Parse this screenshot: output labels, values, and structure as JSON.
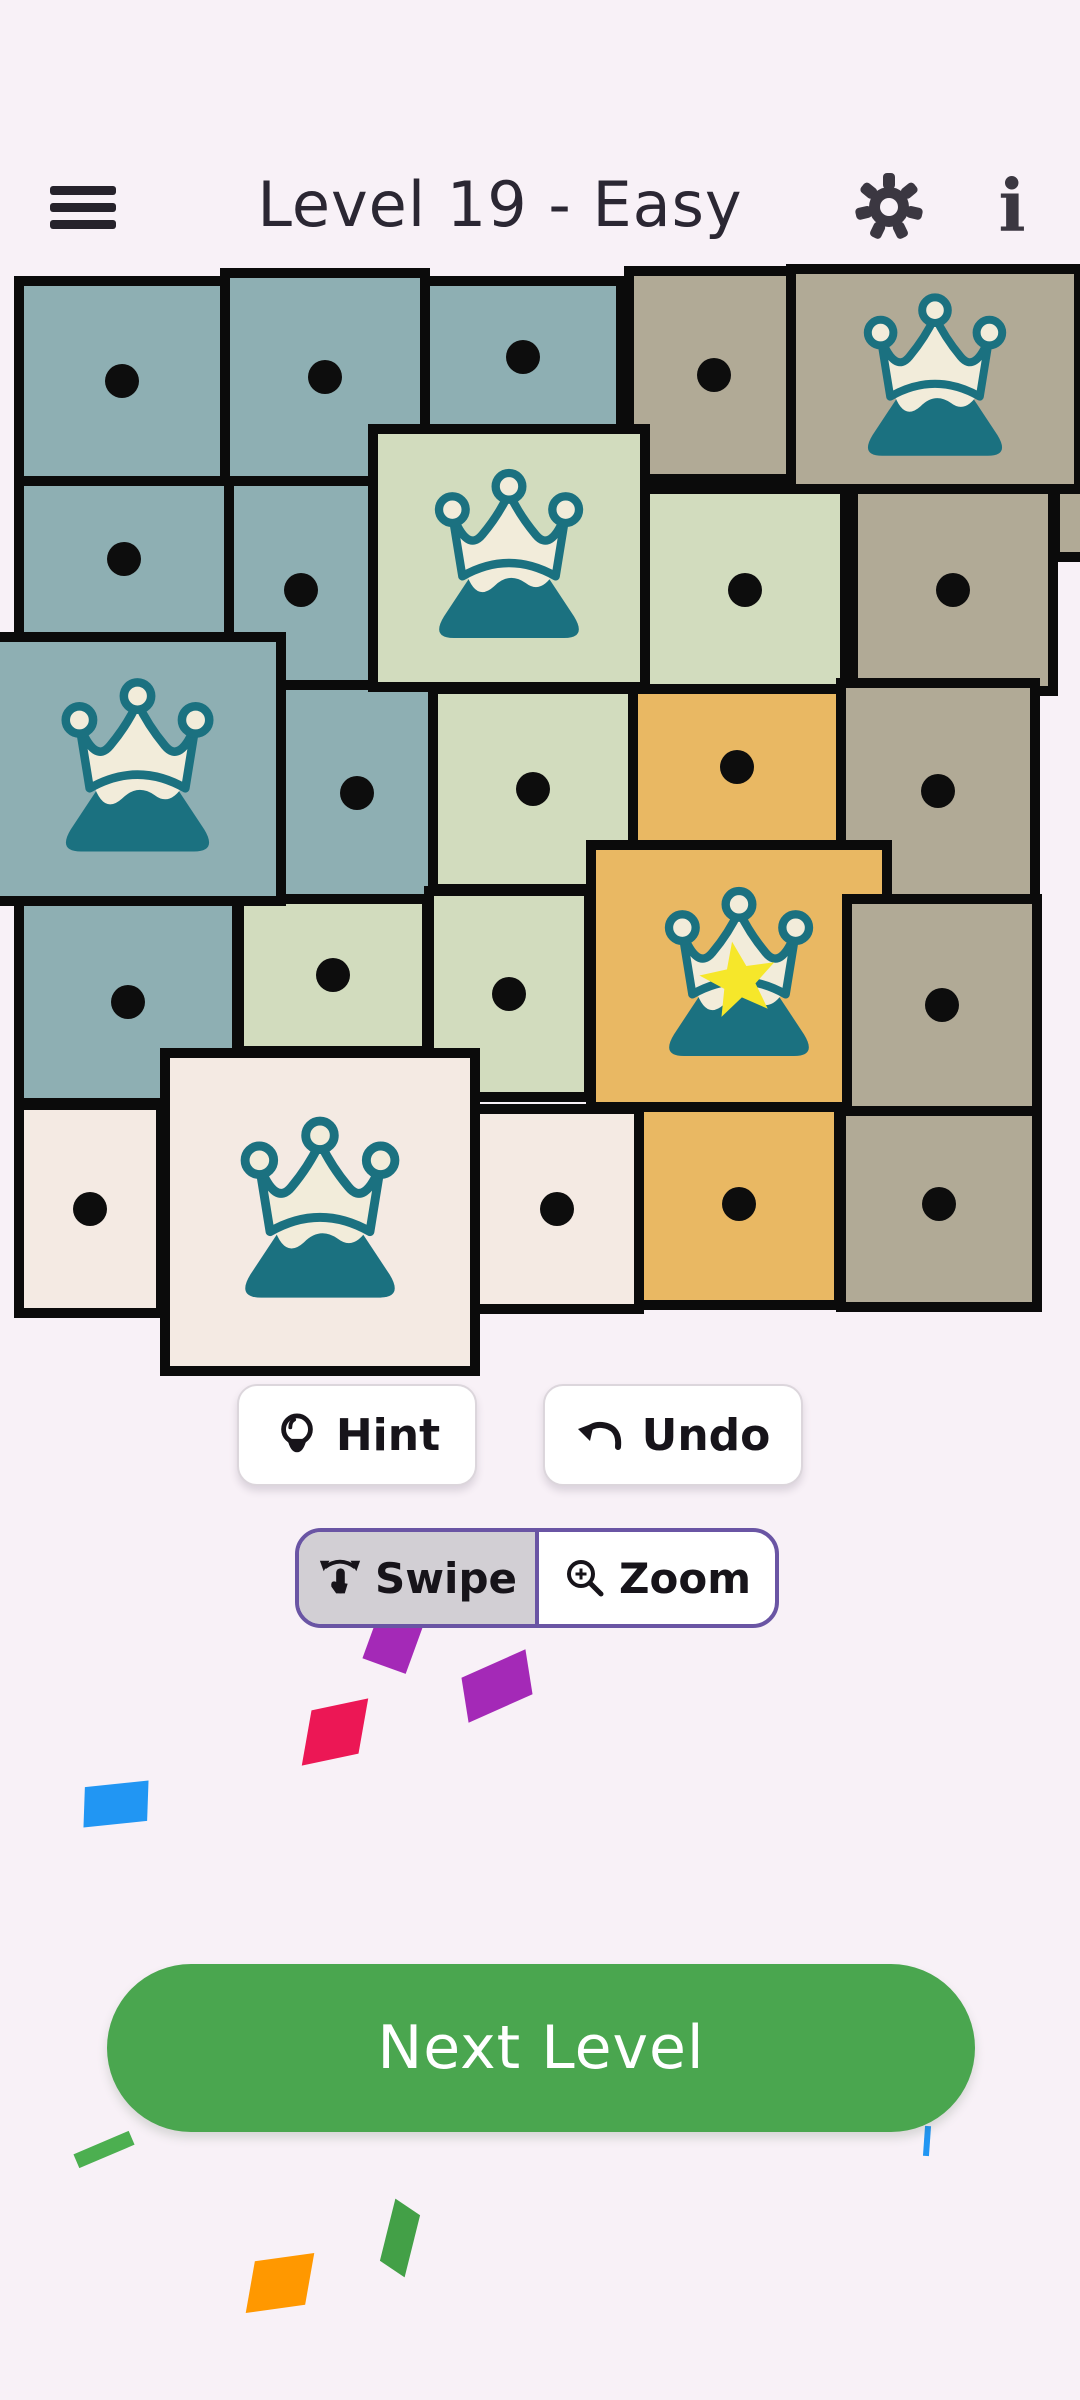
{
  "background": "#f8f1f7",
  "header": {
    "title": "Level 19 - Easy",
    "info_glyph": "i",
    "icon_color": "#3b3741"
  },
  "board": {
    "rows": 5,
    "cols": 5,
    "border_color": "#0b0b0b",
    "dot_color": "#0d0d0d",
    "palette": {
      "teal": "#8eafb3",
      "green": "#d2dcbe",
      "tan": "#b1aa96",
      "orange": "#e9b863",
      "cream": "#f4eae3"
    },
    "crown_colors": {
      "mountain_teal": "#1b7180",
      "crown_cream": "#f2ecda",
      "star_yellow": "#f6e72a"
    },
    "cells": [
      {
        "row": 1,
        "col": 1,
        "color": "teal",
        "content": "dot",
        "x": 14,
        "y": 276,
        "w": 216,
        "h": 210
      },
      {
        "row": 1,
        "col": 2,
        "color": "teal",
        "content": "dot",
        "x": 220,
        "y": 268,
        "w": 210,
        "h": 218
      },
      {
        "row": 1,
        "col": 3,
        "color": "teal",
        "content": "dot",
        "x": 420,
        "y": 276,
        "w": 206,
        "h": 162
      },
      {
        "row": 1,
        "col": 4,
        "color": "tan",
        "content": "dot",
        "x": 624,
        "y": 266,
        "w": 180,
        "h": 218
      },
      {
        "row": 2,
        "col": 1,
        "color": "teal",
        "content": "dot",
        "x": 14,
        "y": 476,
        "w": 220,
        "h": 166
      },
      {
        "row": 2,
        "col": 2,
        "color": "teal",
        "content": "dot",
        "x": 224,
        "y": 476,
        "w": 154,
        "h": 228
      },
      {
        "row": 2,
        "col": 4,
        "color": "green",
        "content": "dot",
        "x": 640,
        "y": 484,
        "w": 210,
        "h": 212
      },
      {
        "row": 2,
        "col": 5,
        "color": "tan",
        "content": "dot",
        "x": 848,
        "y": 484,
        "w": 210,
        "h": 212
      },
      {
        "row": 1,
        "col": 5,
        "color": "tan",
        "content": "none",
        "note": "right-edge tab of crown region",
        "x": 1050,
        "y": 478,
        "w": 44,
        "h": 84
      },
      {
        "row": 3,
        "col": 2,
        "color": "teal",
        "content": "dot",
        "x": 276,
        "y": 680,
        "w": 162,
        "h": 226
      },
      {
        "row": 3,
        "col": 3,
        "color": "green",
        "content": "dot",
        "x": 428,
        "y": 684,
        "w": 210,
        "h": 210
      },
      {
        "row": 3,
        "col": 4,
        "color": "orange",
        "content": "dot",
        "x": 628,
        "y": 684,
        "w": 218,
        "h": 166
      },
      {
        "row": 3,
        "col": 5,
        "color": "tan",
        "content": "dot",
        "x": 836,
        "y": 678,
        "w": 204,
        "h": 226
      },
      {
        "row": 4,
        "col": 1,
        "color": "teal",
        "content": "dot",
        "x": 14,
        "y": 896,
        "w": 228,
        "h": 212
      },
      {
        "row": 4,
        "col": 2,
        "color": "green",
        "content": "dot",
        "x": 234,
        "y": 894,
        "w": 198,
        "h": 162
      },
      {
        "row": 4,
        "col": 3,
        "color": "green",
        "content": "dot",
        "x": 424,
        "y": 886,
        "w": 170,
        "h": 216
      },
      {
        "row": 5,
        "col": 1,
        "color": "cream",
        "content": "dot",
        "x": 14,
        "y": 1100,
        "w": 152,
        "h": 218
      },
      {
        "row": 5,
        "col": 3,
        "color": "cream",
        "content": "dot",
        "x": 470,
        "y": 1104,
        "w": 174,
        "h": 210
      },
      {
        "row": 5,
        "col": 4,
        "color": "orange",
        "content": "dot",
        "x": 634,
        "y": 1098,
        "w": 210,
        "h": 212
      },
      {
        "row": 5,
        "col": 5,
        "color": "tan",
        "content": "dot",
        "x": 836,
        "y": 1096,
        "w": 206,
        "h": 216
      },
      {
        "row": 1,
        "col": 5,
        "color": "tan",
        "content": "crown",
        "x": 786,
        "y": 264,
        "w": 298,
        "h": 230,
        "icon": 192
      },
      {
        "row": 2,
        "col": 3,
        "color": "green",
        "content": "crown",
        "x": 368,
        "y": 424,
        "w": 282,
        "h": 268,
        "icon": 200
      },
      {
        "row": 3,
        "col": 1,
        "color": "teal",
        "content": "crown",
        "x": -12,
        "y": 632,
        "w": 298,
        "h": 274,
        "icon": 205
      },
      {
        "row": 4,
        "col": 4,
        "color": "orange",
        "content": "crown-star",
        "x": 586,
        "y": 840,
        "w": 306,
        "h": 272,
        "icon": 200
      },
      {
        "row": 4,
        "col": 5,
        "color": "tan",
        "content": "dot",
        "x": 842,
        "y": 894,
        "w": 200,
        "h": 222
      },
      {
        "row": 5,
        "col": 2,
        "color": "cream",
        "content": "crown",
        "x": 160,
        "y": 1048,
        "w": 320,
        "h": 328,
        "icon": 214
      }
    ]
  },
  "toolbar": {
    "hint_label": "Hint",
    "undo_label": "Undo"
  },
  "mode_toggle": {
    "swipe_label": "Swipe",
    "zoom_label": "Zoom",
    "selected": "Swipe",
    "border_color": "#6a55a4",
    "selected_bg": "#d2cfd4"
  },
  "next_level": {
    "label": "Next Level",
    "bg": "#4aa64f"
  },
  "confetti": [
    {
      "name": "confetti-purple-1",
      "color": "#a429b7",
      "x": 372,
      "y": 1604,
      "w": 46,
      "h": 64,
      "rot": 20,
      "skewX": 0,
      "skewY": 0
    },
    {
      "name": "confetti-purple-2",
      "color": "#a429b7",
      "x": 462,
      "y": 1664,
      "w": 70,
      "h": 44,
      "rot": -24,
      "skewX": -15,
      "skewY": 0
    },
    {
      "name": "confetti-crimson",
      "color": "#ec1755",
      "x": 306,
      "y": 1706,
      "w": 58,
      "h": 52,
      "rot": -12,
      "skewX": -22,
      "skewY": 0
    },
    {
      "name": "confetti-blue-1",
      "color": "#2196f3",
      "x": 84,
      "y": 1784,
      "w": 64,
      "h": 40,
      "rot": -6,
      "skewX": -8,
      "skewY": 0
    },
    {
      "name": "confetti-green-1",
      "color": "#4caf50",
      "x": 74,
      "y": 2142,
      "w": 60,
      "h": 15,
      "rot": -23,
      "skewX": 0,
      "skewY": 0
    },
    {
      "name": "confetti-green-2",
      "color": "#43a047",
      "x": 386,
      "y": 2206,
      "w": 28,
      "h": 64,
      "rot": 14,
      "skewX": 0,
      "skewY": 20
    },
    {
      "name": "confetti-orange",
      "color": "#ff9800",
      "x": 250,
      "y": 2258,
      "w": 60,
      "h": 50,
      "rot": -8,
      "skewX": -18,
      "skewY": 0
    },
    {
      "name": "confetti-blue-2",
      "color": "#2196f3",
      "x": 924,
      "y": 2126,
      "w": 6,
      "h": 30,
      "rot": 4,
      "skewX": 0,
      "skewY": 0
    }
  ]
}
